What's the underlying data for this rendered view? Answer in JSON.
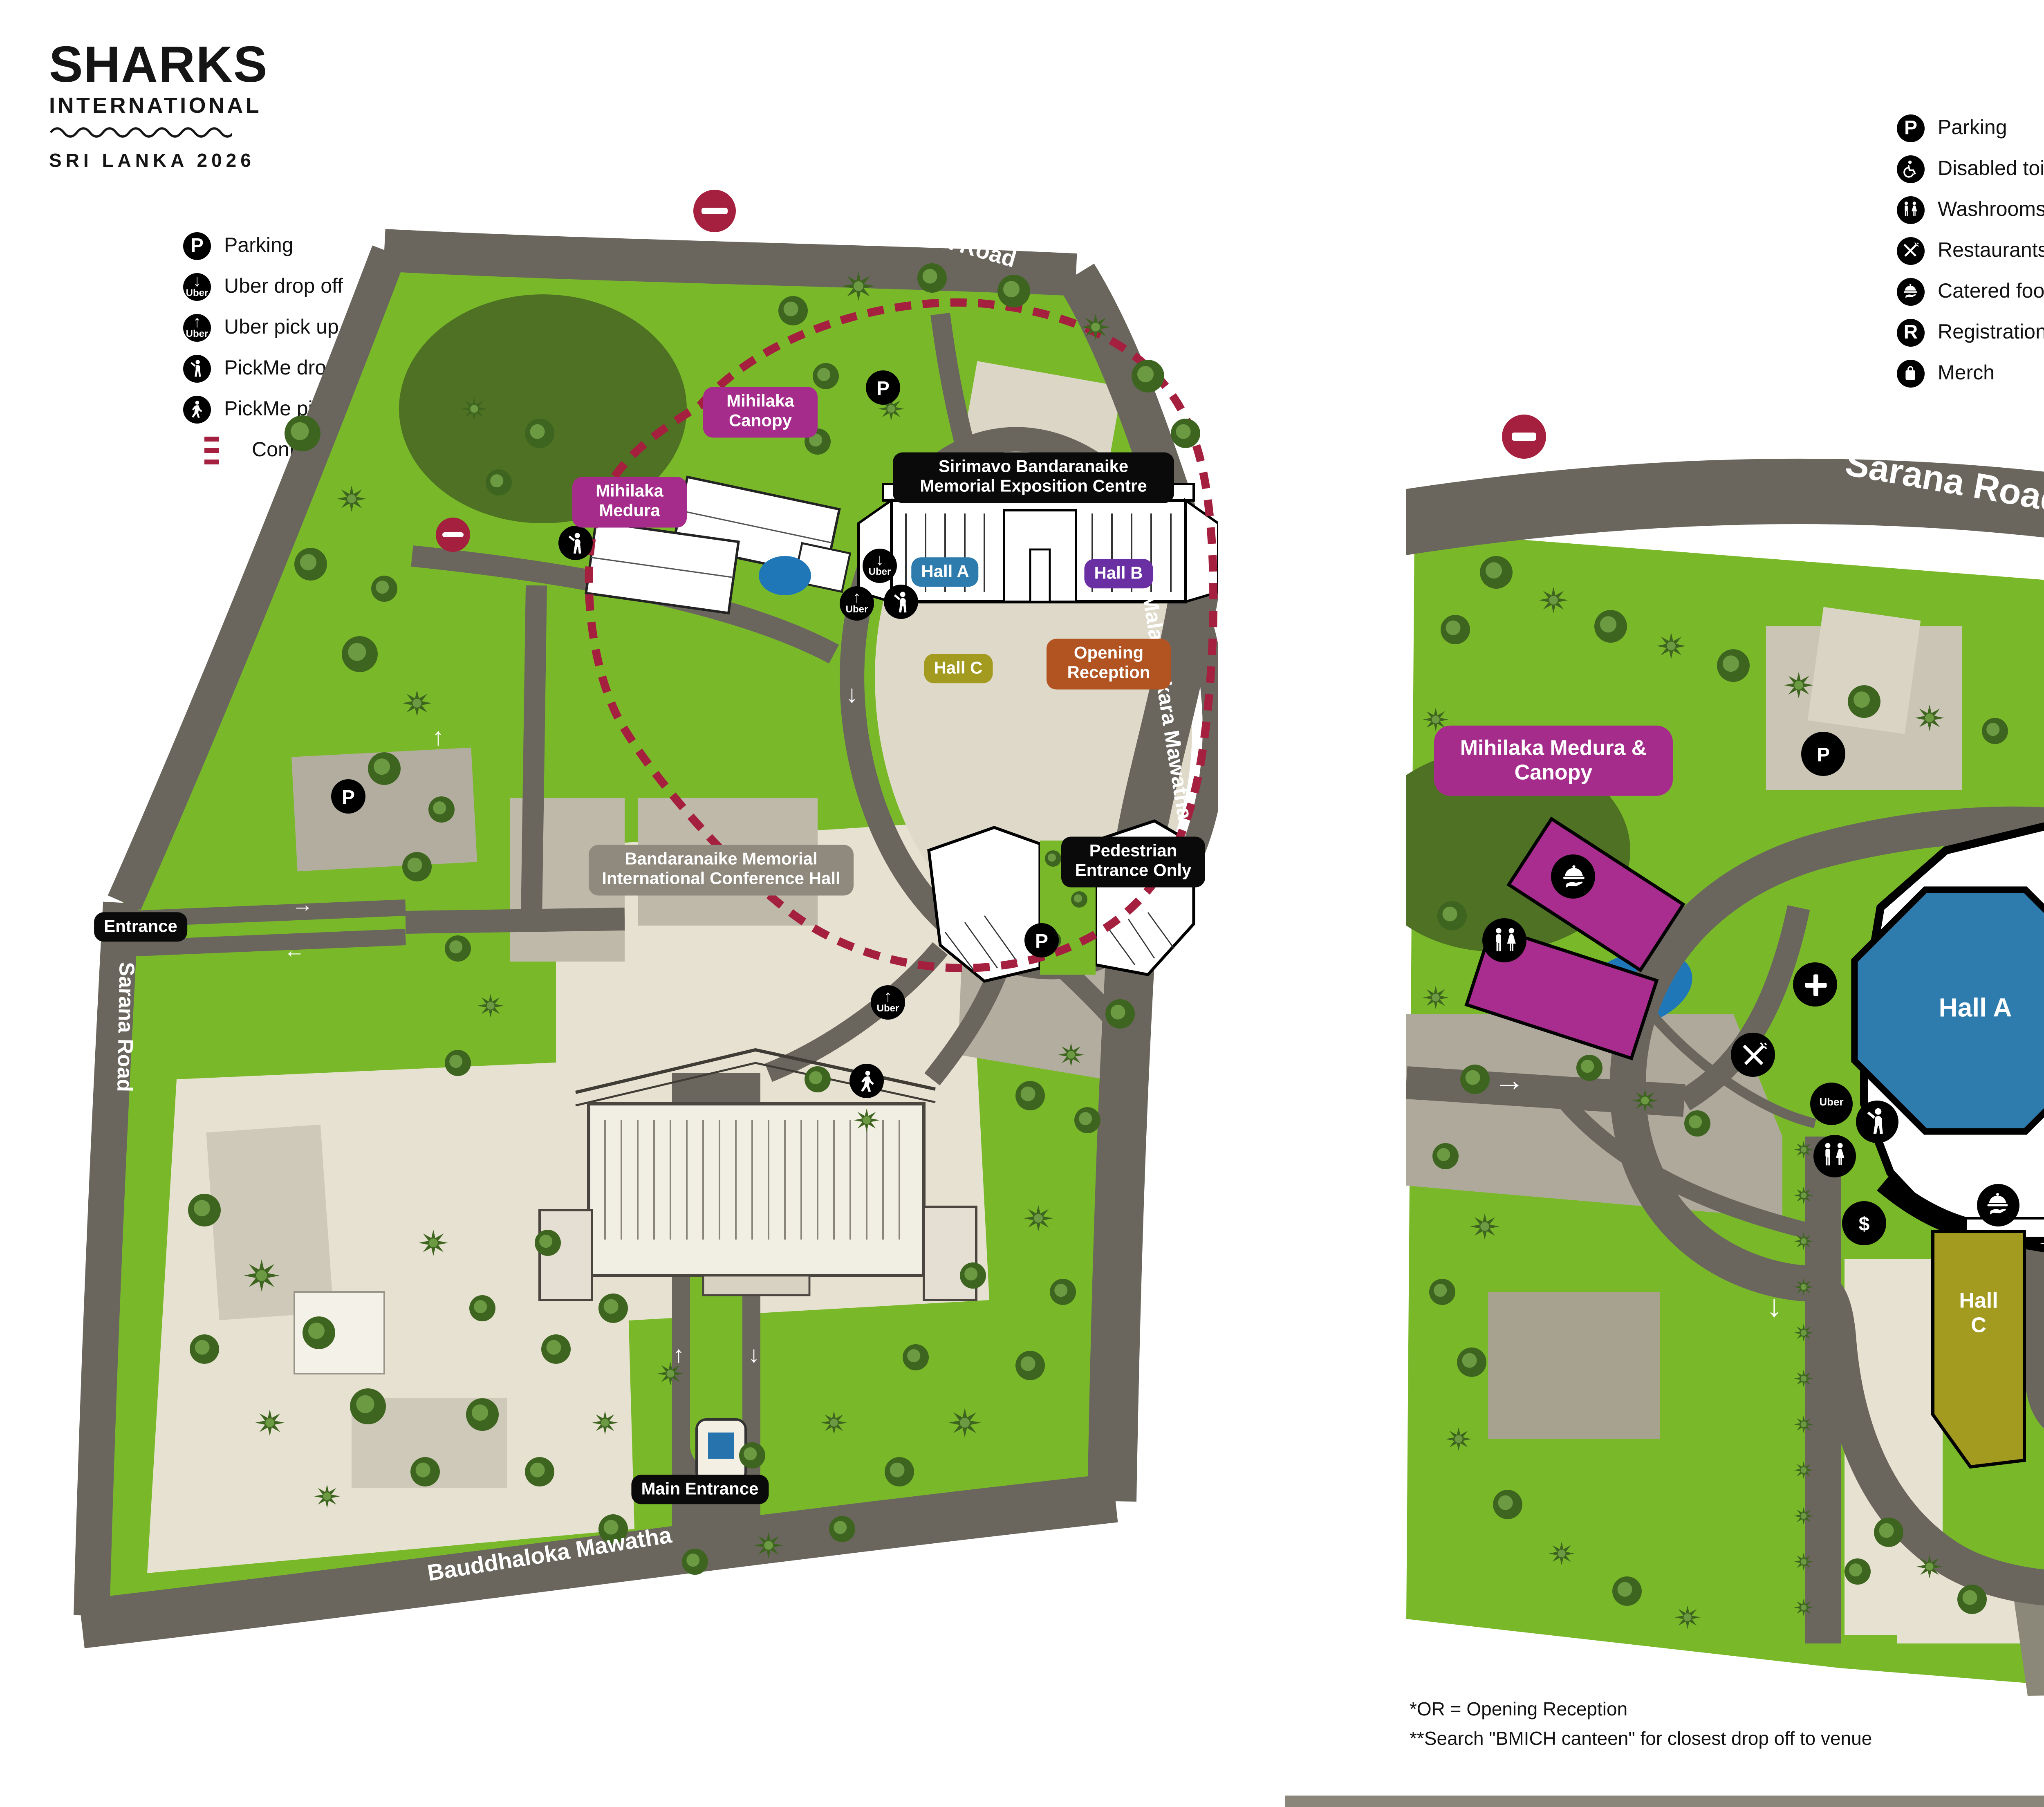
{
  "logo": {
    "title": "SHARKS",
    "subtitle": "INTERNATIONAL",
    "event": "SRI LANKA 2026"
  },
  "icons": {
    "parking": "P",
    "registration": "R",
    "information": "i",
    "atm": "$",
    "uber": "Uber",
    "uber_drop_arrow": "↓",
    "uber_pick_arrow": "↑"
  },
  "left_map": {
    "legend": [
      {
        "icon": "parking",
        "label": "Parking"
      },
      {
        "icon": "uber-drop",
        "label": "Uber drop off"
      },
      {
        "icon": "uber-pick",
        "label": "Uber pick up"
      },
      {
        "icon": "pickme",
        "label": "PickMe drop off"
      },
      {
        "icon": "walker",
        "label": "PickMe pick up"
      },
      {
        "icon": "dashes",
        "label": "Conference area"
      }
    ],
    "roads": {
      "sarana_top": "Sarana Road",
      "sarana_left": "Sarana Road",
      "malalasekara": "Malalasekara Mawatha",
      "bauddhaloka": "Bauddhaloka Mawatha"
    },
    "labels": {
      "mihilaka_canopy": "Mihilaka Canopy",
      "mihilaka_medura": "Mihilaka Medura",
      "exposition_centre": "Sirimavo Bandaranaike Memorial Exposition Centre",
      "hall_a": "Hall A",
      "hall_b": "Hall B",
      "hall_c": "Hall C",
      "opening_reception": "Opening Reception",
      "bmich": "Bandaranaike Memorial International Conference Hall",
      "entrance": "Entrance",
      "main_entrance": "Main Entrance",
      "pedestrian_entrance": "Pedestrian Entrance Only"
    }
  },
  "right_map": {
    "legend_col1": [
      {
        "icon": "parking",
        "label": "Parking"
      },
      {
        "icon": "wheelchair",
        "label": "Disabled toilet"
      },
      {
        "icon": "washrooms",
        "label": "Washrooms"
      },
      {
        "icon": "restaurants",
        "label": "Restaurants ($)"
      },
      {
        "icon": "catered",
        "label": "Catered food"
      },
      {
        "icon": "registration",
        "label": "Registration"
      },
      {
        "icon": "merch",
        "label": "Merch"
      }
    ],
    "legend_col2": [
      {
        "icon": "information",
        "label": "Information desk"
      },
      {
        "icon": "prayer",
        "label": "Prayer room"
      },
      {
        "icon": "atm",
        "label": "ATM"
      },
      {
        "icon": "ambulance",
        "label": "Ambulance"
      },
      {
        "icon": "uber",
        "label": "Uber**"
      },
      {
        "icon": "pickme",
        "label": "PickMe (drop off only)**"
      }
    ],
    "roads": {
      "sarana": "Sarana Road",
      "malalasekara": "Malalasekara Mawatha"
    },
    "labels": {
      "mihilaka": "Mihilaka Medura & Canopy",
      "hall_a": "Hall A",
      "hall_b": "Hall B",
      "hall_c": "Hall C",
      "opening_reception_short": "OR*",
      "pedestrian_entrance": "Pedestrian Entrance Only"
    }
  },
  "footnotes": {
    "or": "*OR = Opening Reception",
    "search": "**Search \"BMICH canteen\" for closest drop off to venue"
  },
  "colors": {
    "green": "#79B929",
    "dark_green": "#4E7123",
    "road": "#6A665E",
    "beige": "#E7E1D1",
    "magenta": "#A82D8F",
    "blue": "#2E7CAD",
    "purple": "#6B2FA4",
    "olive": "#A39B20",
    "orange": "#B25322",
    "crimson": "#A5203F",
    "pond": "#1F77B8",
    "black": "#0A0A0A"
  }
}
